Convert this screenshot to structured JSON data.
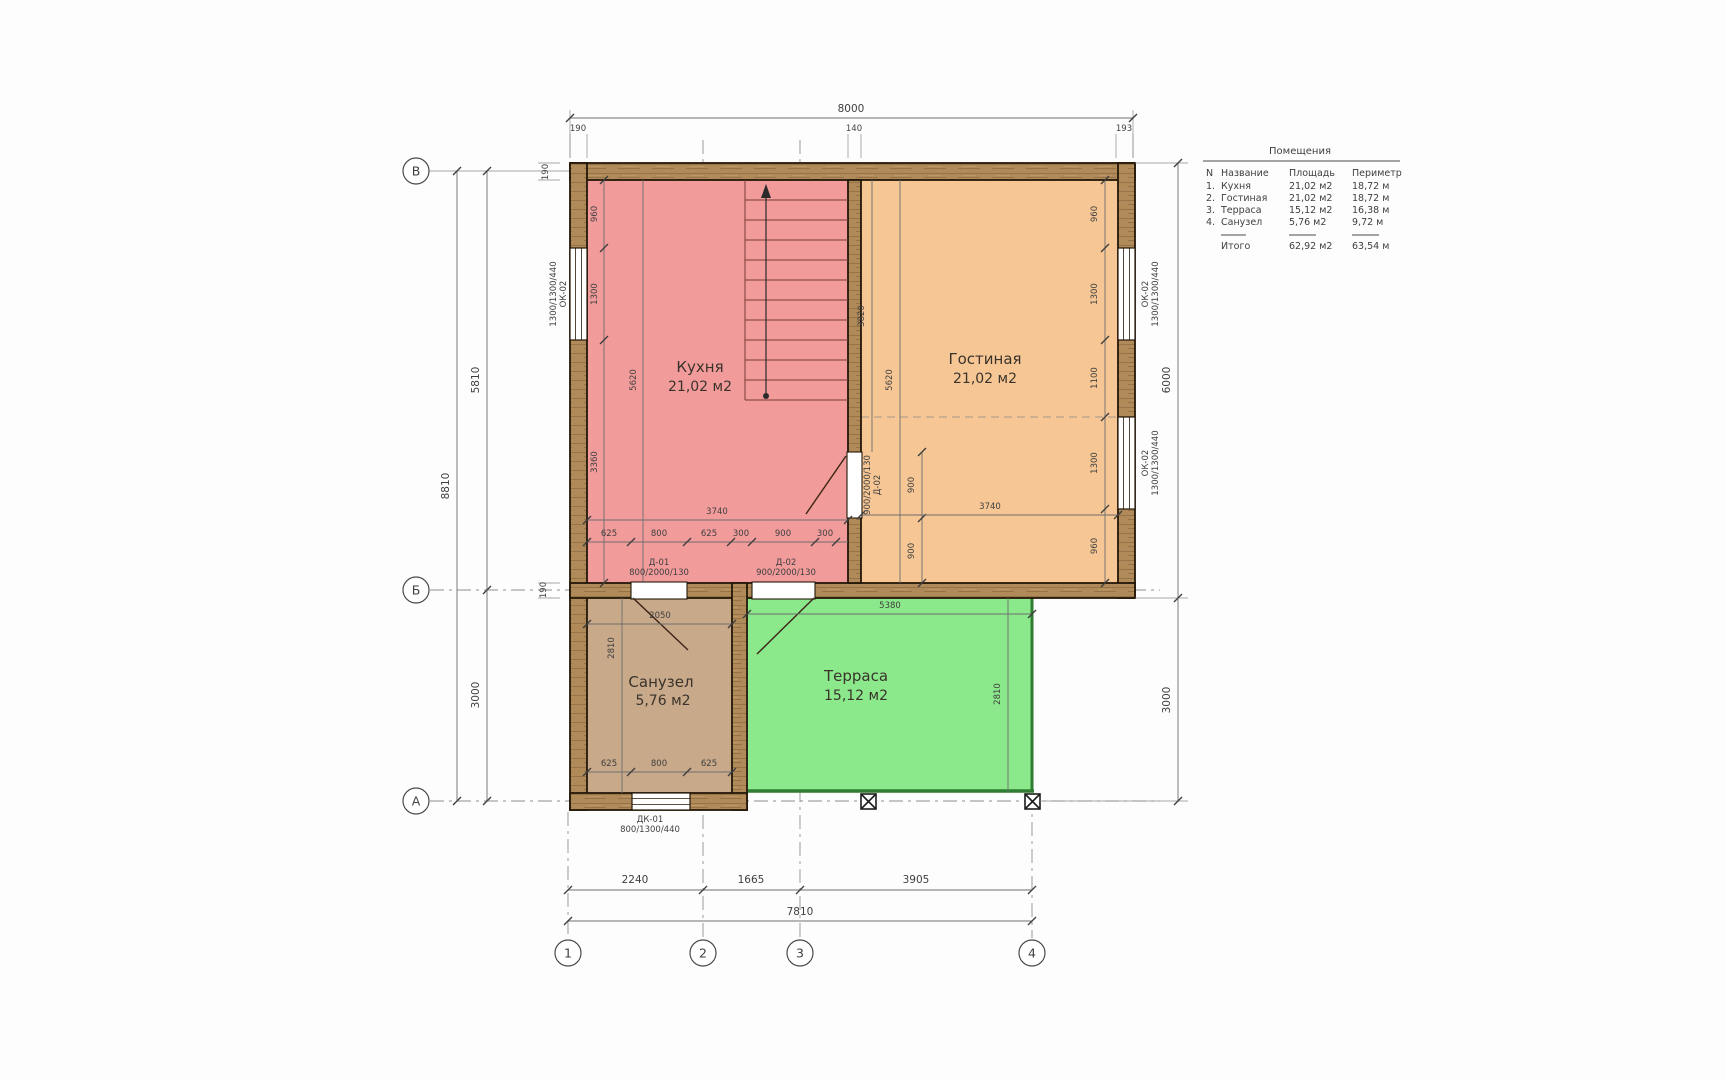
{
  "title_block": {
    "title": "Помещения",
    "columns": {
      "n": "N",
      "name": "Название",
      "area": "Площадь",
      "perimeter": "Периметр"
    },
    "rows": [
      {
        "n": "1.",
        "name": "Кухня",
        "area": "21,02 м2",
        "perimeter": "18,72 м"
      },
      {
        "n": "2.",
        "name": "Гостиная",
        "area": "21,02 м2",
        "perimeter": "18,72 м"
      },
      {
        "n": "3.",
        "name": "Терраса",
        "area": "15,12 м2",
        "perimeter": "16,38 м"
      },
      {
        "n": "4.",
        "name": "Санузел",
        "area": "5,76 м2",
        "perimeter": "9,72 м"
      }
    ],
    "total": {
      "label": "Итого",
      "area": "62,92 м2",
      "perimeter": "63,54 м"
    }
  },
  "rooms": {
    "kitchen": {
      "name": "Кухня",
      "area": "21,02 м2",
      "color": "#f29b9b"
    },
    "living": {
      "name": "Гостиная",
      "area": "21,02 м2",
      "color": "#f6c795"
    },
    "terrace": {
      "name": "Терраса",
      "area": "15,12 м2",
      "color": "#8be88b"
    },
    "bathroom": {
      "name": "Санузел",
      "area": "5,76 м2",
      "color": "#c8a98a"
    }
  },
  "axes": {
    "row_top": "В",
    "row_mid": "Б",
    "row_bot": "А",
    "col_1": "1",
    "col_2": "2",
    "col_3": "3",
    "col_4": "4"
  },
  "dims": {
    "top_total": "8000",
    "top_190": "190",
    "top_140": "140",
    "top_193": "193",
    "left_8810": "8810",
    "left_5810": "5810",
    "left_3000": "3000",
    "left_190_top": "190",
    "left_190_mid": "190",
    "right_6000": "6000",
    "right_3000": "3000",
    "bot_2240": "2240",
    "bot_1665": "1665",
    "bot_3905": "3905",
    "bot_7810": "7810",
    "k_960": "960",
    "k_1300": "1300",
    "k_3360": "3360",
    "k_5620": "5620",
    "k_3740": "3740",
    "k_625a": "625",
    "k_800": "800",
    "k_625b": "625",
    "k_300a": "300",
    "k_900": "900",
    "k_300b": "300",
    "l_3820": "3820",
    "l_5620": "5620",
    "l_900a": "900",
    "l_900b": "900",
    "l_3740": "3740",
    "r_960a": "960",
    "r_1300a": "1300",
    "r_1100": "1100",
    "r_1300b": "1300",
    "r_960b": "960",
    "b_2050": "2050",
    "b_2810": "2810",
    "b_625a": "625",
    "b_800": "800",
    "b_625b": "625",
    "t_5380": "5380",
    "t_2810": "2810"
  },
  "openings": {
    "window_left": {
      "mark": "ОК-02",
      "size": "1300/1300/440"
    },
    "window_right_top": {
      "mark": "ОК-02",
      "size": "1300/1300/440"
    },
    "window_right_bottom": {
      "mark": "ОК-02",
      "size": "1300/1300/440"
    },
    "window_bath": {
      "mark": "ДК-01",
      "size": "800/1300/440"
    },
    "door_bath": {
      "mark": "Д-01",
      "size": "800/2000/130"
    },
    "door_terrace": {
      "mark": "Д-02",
      "size": "900/2000/130"
    },
    "door_living": {
      "mark": "Д-02",
      "size": "900/2000/130"
    }
  }
}
